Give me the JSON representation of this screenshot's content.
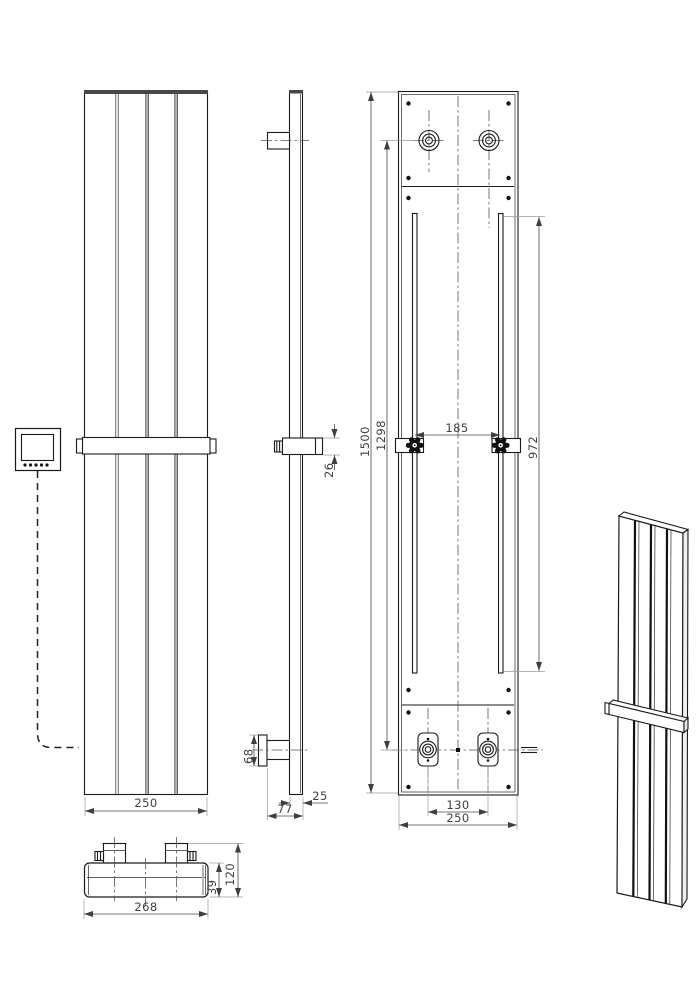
{
  "colors": {
    "background": "#ffffff",
    "outline": "#1a1a1a",
    "dimension_text": "#3f3f3f",
    "extension_line": "#9a9a9a"
  },
  "dims": {
    "front_width": "250",
    "towel_bar_diameter": "26",
    "side_bottom_bracket_height": "68",
    "side_profile_depth": "25",
    "side_total_depth": "77",
    "rear_overall_height": "1500",
    "rear_pipe_centres_height": "1298",
    "rear_rail_length": "972",
    "rear_bracket_spacing": "185",
    "rear_pipe_centres_width": "130",
    "rear_overall_width": "250",
    "bottom_overall_width": "268",
    "bottom_overall_depth": "120",
    "bottom_body_depth": "39"
  }
}
